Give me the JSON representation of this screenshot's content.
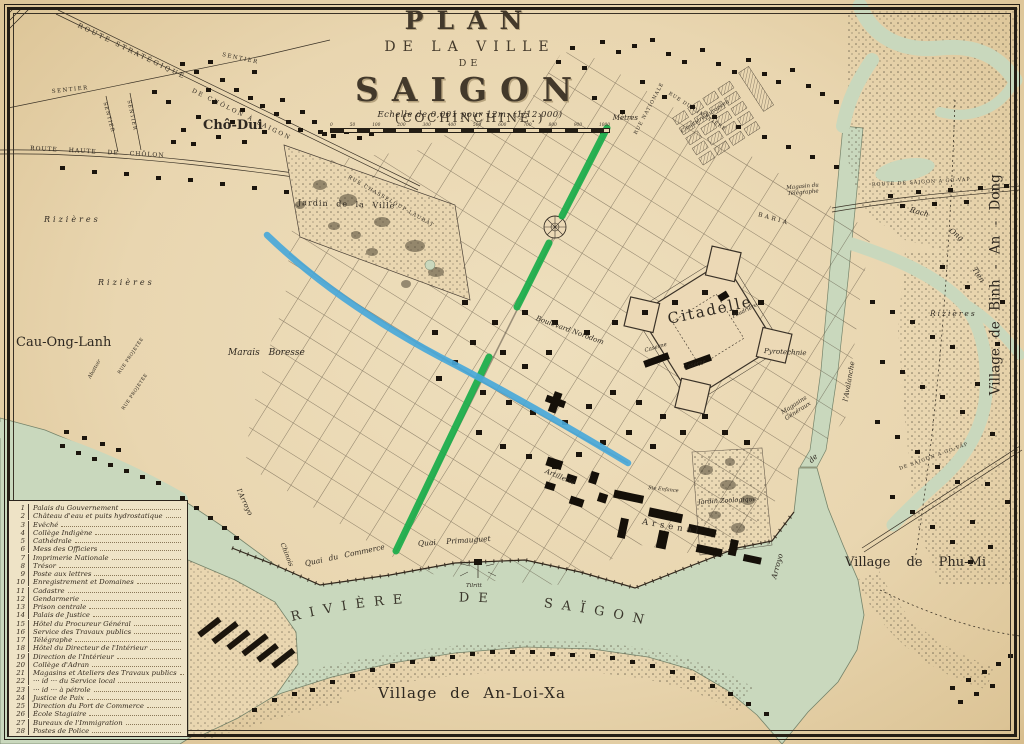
{
  "title": {
    "line1": "PLAN",
    "line2": "DE LA VILLE",
    "line3": "DE",
    "line4": "SAIGON",
    "line5": "(COCHINCHINE.)"
  },
  "scale": {
    "text": "Echelle de 0,001 pour 12m. (1/12.000)",
    "unit": "Mètres",
    "ticks": [
      "0",
      "50",
      "100",
      "200",
      "300",
      "400",
      "500",
      "600",
      "700",
      "800",
      "900",
      "1000"
    ]
  },
  "legend": {
    "items": [
      {
        "num": "1",
        "label": "Palais du Gouvernement"
      },
      {
        "num": "2",
        "label": "Château d'eau et puits hydrostatique"
      },
      {
        "num": "3",
        "label": "Evêché"
      },
      {
        "num": "4",
        "label": "Collège Indigène"
      },
      {
        "num": "5",
        "label": "Cathédrale"
      },
      {
        "num": "6",
        "label": "Mess des Officiers"
      },
      {
        "num": "7",
        "label": "Imprimerie Nationale"
      },
      {
        "num": "8",
        "label": "Trésor"
      },
      {
        "num": "9",
        "label": "Poste aux lettres"
      },
      {
        "num": "10",
        "label": "Enregistrement et Domaines"
      },
      {
        "num": "11",
        "label": "Cadastre"
      },
      {
        "num": "12",
        "label": "Gendarmerie"
      },
      {
        "num": "13",
        "label": "Prison centrale"
      },
      {
        "num": "14",
        "label": "Palais de Justice"
      },
      {
        "num": "15",
        "label": "Hôtel du Procureur Général"
      },
      {
        "num": "16",
        "label": "Service des Travaux publics"
      },
      {
        "num": "17",
        "label": "Télégraphe"
      },
      {
        "num": "18",
        "label": "Hôtel du Directeur de l'Intérieur"
      },
      {
        "num": "19",
        "label": "Direction de l'Intérieur"
      },
      {
        "num": "20",
        "label": "Collège d'Adran"
      },
      {
        "num": "21",
        "label": "Magasins et Ateliers des Travaux publics"
      },
      {
        "num": "22",
        "label": "··· id ··· du Service local"
      },
      {
        "num": "23",
        "label": "··· id ··· à pétrole"
      },
      {
        "num": "24",
        "label": "Justice de Paix"
      },
      {
        "num": "25",
        "label": "Direction du Port de Commerce"
      },
      {
        "num": "26",
        "label": "École Stagiaire"
      },
      {
        "num": "27",
        "label": "Bureaux de l'Immigration"
      },
      {
        "num": "28",
        "label": "Postes de Police"
      }
    ]
  },
  "map": {
    "colors": {
      "paper": "#e9d6b0",
      "water": "#c9d8bd",
      "ink": "#2b241c",
      "highlight_green": "#1fae4d",
      "highlight_blue": "#49a8d9"
    },
    "labels": {
      "route_strategique": "ROUTE STRATÉGIQUE",
      "de_cholon": "DE CHÔLON À SAIGON",
      "sentier_a": "SENTIER",
      "sentier_b": "SENTIER",
      "sentier_c": "SENTIER",
      "sentier_d": "SENTIER",
      "route_haute": "ROUTE HAUTE DE CHÔLON",
      "cho_dui": "Chô-Dui",
      "rizieres_a": "Rizières",
      "rizieres_b": "Rizières",
      "rizieres_right": "Rizières",
      "cau_ong_lanh": "Cau-Ong-Lanh",
      "marais_boresse": "Marais Boresse",
      "jardin_ville": "Jardin de la Ville",
      "rue_chasseloup": "RUE CHASSELOUP-LAUBAT",
      "bd_norodom": "Boulevard Norodom",
      "rue_nationale": "RUE NATIONALE",
      "rue_cimetiere": "RUE DU CIMETIÈRE",
      "cimetiere": "Cimetière Européen",
      "baria": "BARIA",
      "magasin_telegraphe": "Magasin du Télégraphe",
      "citadelle": "Citadelle",
      "poudriere": "Poudrière",
      "caserne_a": "Caserne",
      "caserne_b": "Caserne",
      "pyrotechnie": "Pyrotechnie",
      "magasins_generaux": "Magasins Généraux",
      "route_govap_top": "ROUTE DE SAIGON A GO-VAP",
      "rach": "Rach",
      "ong": "Ong",
      "tien": "Tien",
      "village_binh": "Village  de  Binh - An - Dong",
      "avalanche": "l'Avalanche",
      "arroyo_av": "Arroyo",
      "arroyo_de": "de",
      "jardin_zoo": "Jardin Zoologique",
      "artillerie": "Artillerie",
      "arsenal": "Arsenal",
      "ste_enfance": "Ste Enfance",
      "quai_commerce": "Quai du Commerce",
      "quai_primauguet": "Quai  Primauguet",
      "arroyo_chinois": "l'Arroyo",
      "chinois_b": "Chinois",
      "abattoir": "Abattoir",
      "rue_projetee_a": "RUE PROJETÉE",
      "rue_projetee_b": "RUE PROJETÉE",
      "tilritt": "Tilritt",
      "riviere": "RIVIÈRE   DE   SAÏGON",
      "village_anloixa": "Village de An-Loi-Xa",
      "village_phumi": "Village de Phu-Mi",
      "govap_bottom": "DE SAIGON A GO-VAP"
    }
  }
}
